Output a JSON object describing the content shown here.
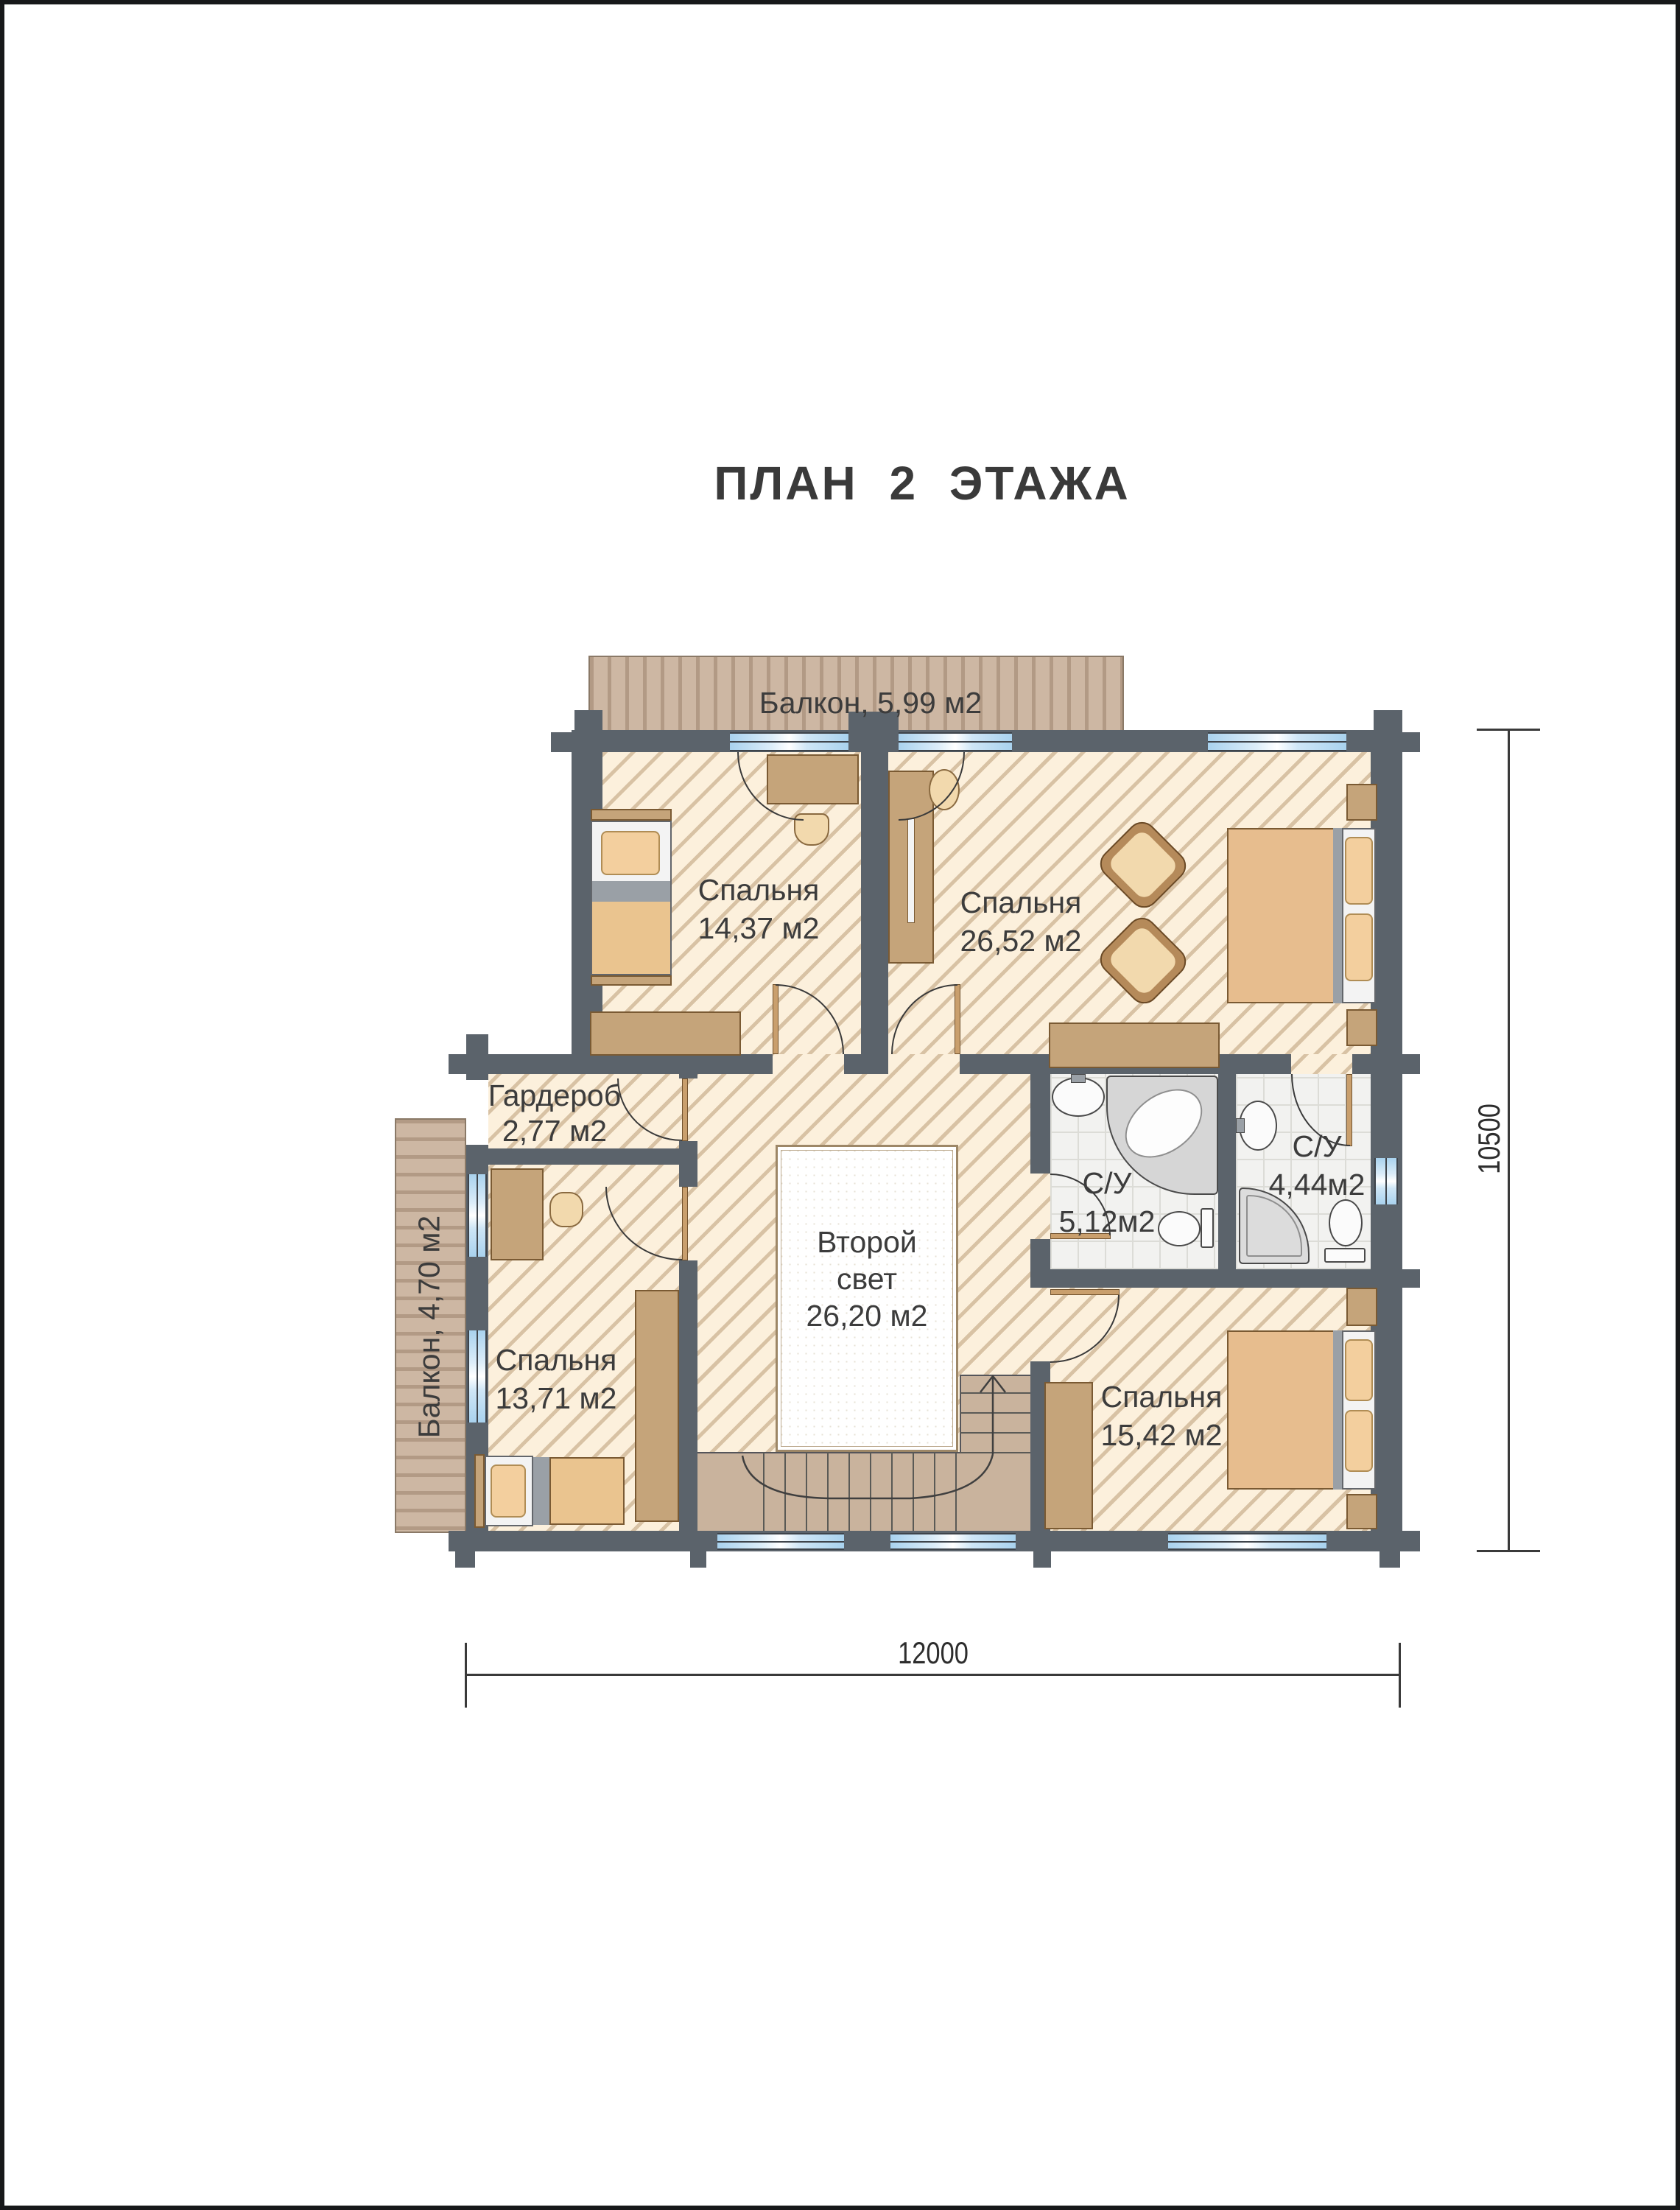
{
  "title": "ПЛАН 2 ЭТАЖА",
  "rooms": {
    "balcony_top": {
      "label": "Балкон, 5,99 м2"
    },
    "bedroom1": {
      "name": "Спальня",
      "area": "14,37 м2"
    },
    "bedroom2": {
      "name": "Спальня",
      "area": "26,52 м2"
    },
    "wardrobe": {
      "name": "Гардероб",
      "area": "2,77 м2"
    },
    "balcony_left": {
      "label": "Балкон, 4,70 м2"
    },
    "bedroom3": {
      "name": "Спальня",
      "area": "13,71 м2"
    },
    "void": {
      "name_line1": "Второй",
      "name_line2": "свет",
      "area": "26,20 м2"
    },
    "bath1": {
      "name": "С/У",
      "area": "5,12м2"
    },
    "bath2": {
      "name": "С/У",
      "area": "4,44м2"
    },
    "bedroom4": {
      "name": "Спальня",
      "area": "15,42 м2"
    }
  },
  "dimensions": {
    "bottom": "12000",
    "right": "10500"
  },
  "colors": {
    "wall": "#5b636b",
    "floor": "#fcf0dc",
    "hatch": "#d8c2a4",
    "window_glass": "#a9d2ee",
    "deck": "#cdb7a3",
    "tile": "#f2f2f0",
    "stairs": "#c9b39d",
    "furniture_wood": "#c5a47a",
    "text": "#3c3c3c"
  }
}
